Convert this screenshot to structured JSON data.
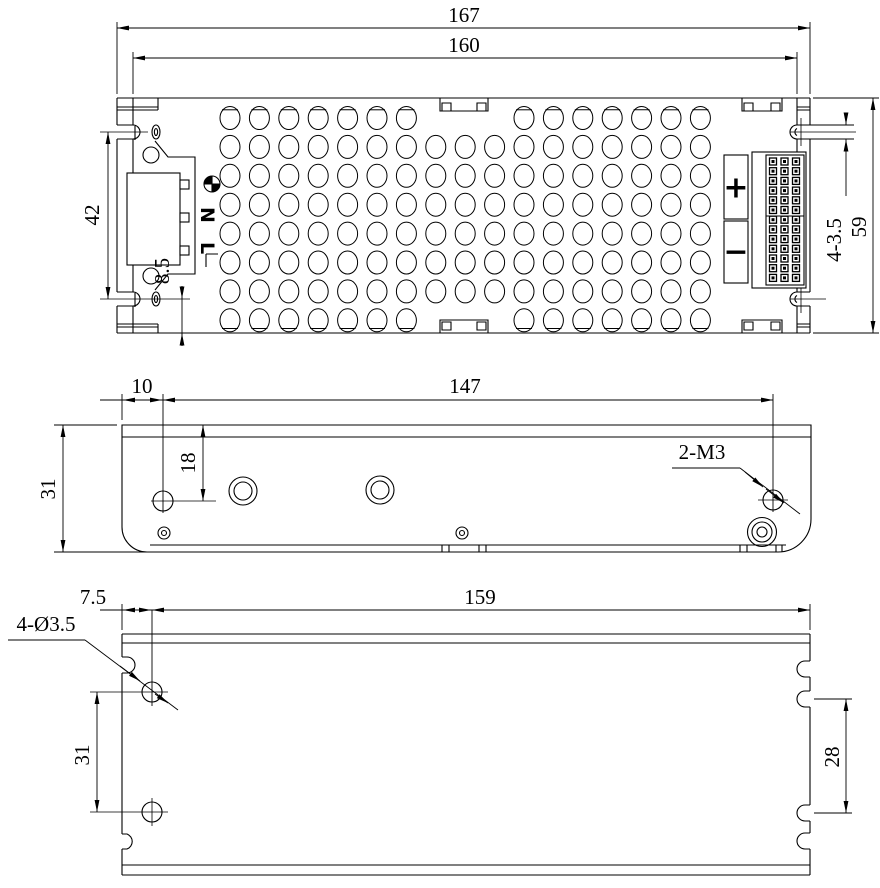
{
  "colors": {
    "line": "#000000",
    "background": "#ffffff"
  },
  "top_view": {
    "dim_overall_length": "167",
    "dim_body_length": "160",
    "dim_slot_span": "42",
    "dim_slot_to_edge": "8.5",
    "dim_slot_width_note": "4-3.5",
    "dim_overall_width": "59",
    "terminal_ground_icon": "earth-ground",
    "terminal_neutral": "N",
    "terminal_live": "L",
    "output_positive": "+",
    "output_negative": "−"
  },
  "side_view": {
    "dim_hole_inset": "10",
    "dim_hole_span": "147",
    "dim_hole_drop": "18",
    "dim_height": "31",
    "thread_note": "2-M3"
  },
  "bottom_view": {
    "dim_hole_inset": "7.5",
    "dim_length": "159",
    "hole_note": "4-Ø3.5",
    "dim_hole_span": "31",
    "dim_slot_span": "28"
  }
}
